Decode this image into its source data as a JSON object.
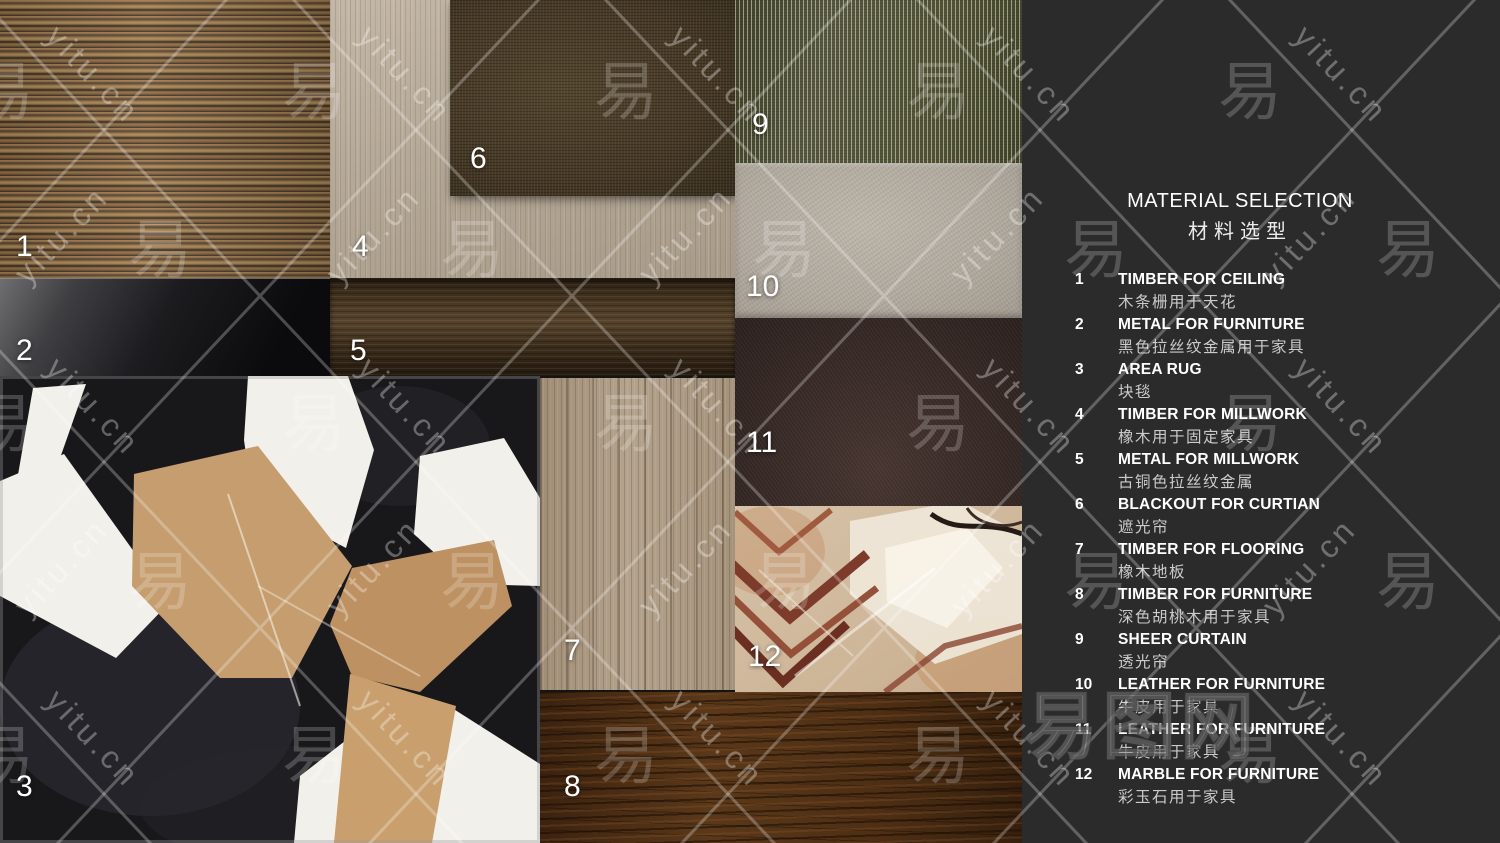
{
  "panel": {
    "title": "MATERIAL SELECTION",
    "subtitle": "材料选型",
    "items": [
      {
        "num": "1",
        "en": "TIMBER FOR CEILING",
        "zh": "木条栅用于天花"
      },
      {
        "num": "2",
        "en": "METAL FOR FURNITURE",
        "zh": "黑色拉丝纹金属用于家具"
      },
      {
        "num": "3",
        "en": "AREA RUG",
        "zh": "块毯"
      },
      {
        "num": "4",
        "en": "TIMBER FOR MILLWORK",
        "zh": "橡木用于固定家具"
      },
      {
        "num": "5",
        "en": "METAL FOR MILLWORK",
        "zh": "古铜色拉丝纹金属"
      },
      {
        "num": "6",
        "en": "BLACKOUT FOR CURTIAN",
        "zh": "遮光帘"
      },
      {
        "num": "7",
        "en": "TIMBER FOR FLOORING",
        "zh": "橡木地板"
      },
      {
        "num": "8",
        "en": "TIMBER FOR FURNITURE",
        "zh": "深色胡桃木用于家具"
      },
      {
        "num": "9",
        "en": "SHEER CURTAIN",
        "zh": "透光帘"
      },
      {
        "num": "10",
        "en": "LEATHER FOR FURNITURE",
        "zh": "牛皮用于家具"
      },
      {
        "num": "11",
        "en": "LEATHER FOR FURNITURE",
        "zh": "牛皮用于家具"
      },
      {
        "num": "12",
        "en": "MARBLE FOR FURNITURE",
        "zh": "彩玉石用于家具"
      }
    ]
  },
  "watermark": {
    "url": "yitu.cn",
    "glyph": "易",
    "logo": "易图网"
  },
  "colors": {
    "panel_background": "#2b2b2b",
    "text_primary": "#ffffff",
    "text_secondary": "#cbcbcb",
    "watermark_line": "rgba(255,255,255,0.26)",
    "swatch_palette": {
      "timber_ceiling": "#8a6a45",
      "metal_furniture": "#1c1c1f",
      "area_rug_black": "#18181b",
      "area_rug_white": "#f2f0ea",
      "area_rug_tan": "#c29a6a",
      "timber_millwork": "#b7ab9b",
      "metal_millwork": "#4c3a24",
      "blackout_curtain": "#473a26",
      "timber_flooring": "#ab9a84",
      "timber_furniture": "#4e2f14",
      "sheer_curtain": "#515337",
      "leather_light": "#b0a99e",
      "leather_dark": "#382a27",
      "marble_base": "#d7c3a9",
      "marble_vein": "#7c3b2b"
    }
  }
}
